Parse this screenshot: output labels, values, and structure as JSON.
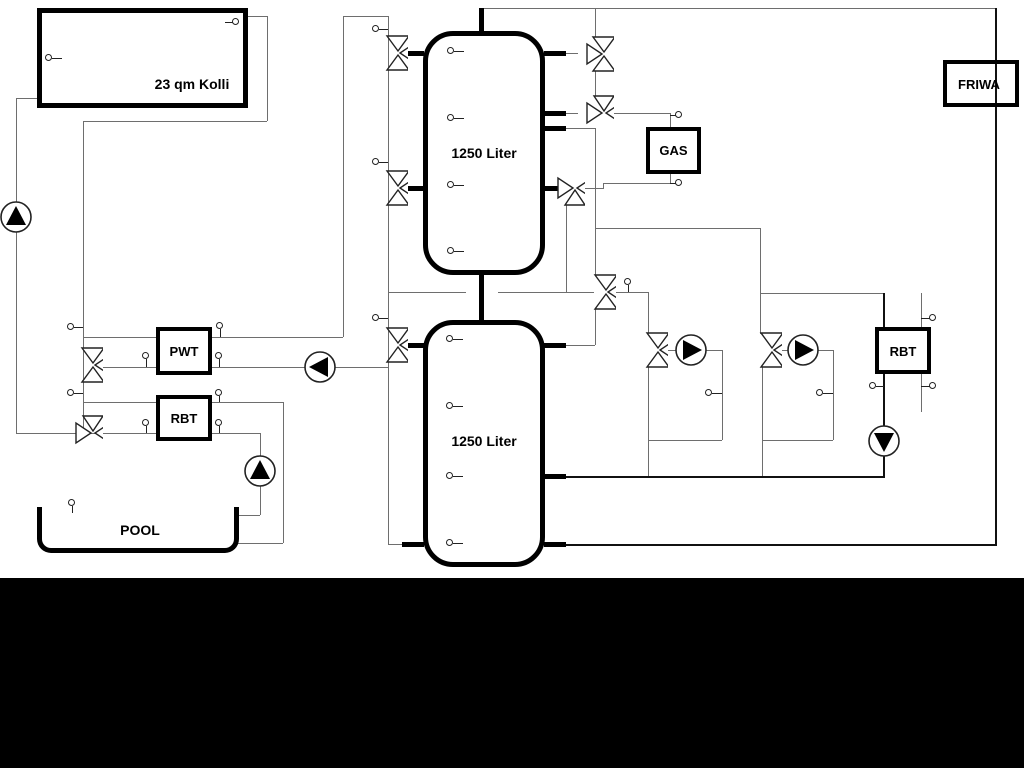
{
  "diagram": {
    "collector": {
      "label": "23 qm Kolli"
    },
    "tank_upper": {
      "label": "1250 Liter"
    },
    "tank_lower": {
      "label": "1250 Liter"
    },
    "gas": {
      "label": "GAS"
    },
    "friwa": {
      "label": "FRIWA"
    },
    "pwt": {
      "label": "PWT"
    },
    "rbt_left": {
      "label": "RBT"
    },
    "rbt_right": {
      "label": "RBT"
    },
    "pool": {
      "label": "POOL"
    },
    "colors": {
      "pipe_gray": "#6e6e6e",
      "pipe_black": "#111111",
      "background": "#ffffff",
      "bottom_bar": "#000000"
    }
  }
}
